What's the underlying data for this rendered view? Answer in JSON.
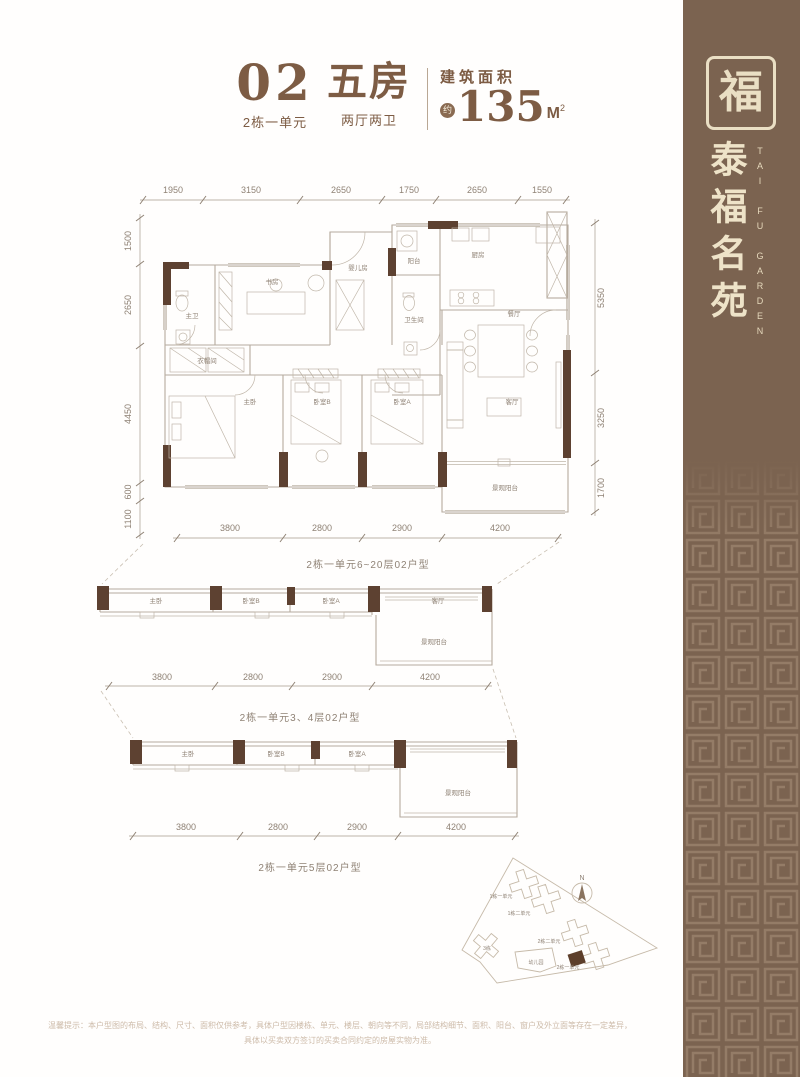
{
  "header": {
    "unit_no": "02",
    "unit_sub": "2栋一单元",
    "type_big": "五房",
    "type_sub": "两厅两卫",
    "area_label": "建筑面积",
    "approx": "约",
    "area_value": "135",
    "area_unit": "M",
    "area_exp": "2"
  },
  "sidebar": {
    "logo_char": "福",
    "brand_cn": "泰福名苑",
    "brand_en": "TAI FU GARDEN"
  },
  "main_plan": {
    "caption": "2栋一单元6~20层02户型",
    "dims_top": [
      "1950",
      "3150",
      "2650",
      "1750",
      "2650",
      "1550"
    ],
    "dims_left": [
      "1500",
      "2650",
      "4450",
      "600",
      "1100"
    ],
    "dims_right": [
      "5350",
      "3250",
      "1700"
    ],
    "dims_bottom": [
      "3800",
      "2800",
      "2900",
      "4200"
    ],
    "rooms": {
      "master_bath": "主卫",
      "study": "书房",
      "baby_room": "婴儿房",
      "balcony": "阳台",
      "kitchen": "厨房",
      "bathroom": "卫生间",
      "dining": "餐厅",
      "cloak": "衣帽间",
      "master_bed": "主卧",
      "bed_b": "卧室B",
      "bed_a": "卧室A",
      "living": "客厅",
      "view_balcony": "景观阳台"
    }
  },
  "mid_plan": {
    "caption": "2栋一单元3、4层02户型",
    "dims": [
      "3800",
      "2800",
      "2900",
      "4200"
    ],
    "rooms": {
      "master_bed": "主卧",
      "bed_b": "卧室B",
      "bed_a": "卧室A",
      "living": "客厅",
      "view_balcony": "景观阳台"
    }
  },
  "low_plan": {
    "caption": "2栋一单元5层02户型",
    "dims": [
      "3800",
      "2800",
      "2900",
      "4200"
    ],
    "rooms": {
      "master_bed": "主卧",
      "bed_b": "卧室B",
      "bed_a": "卧室A",
      "view_balcony": "景观阳台"
    }
  },
  "site_plan": {
    "north": "N",
    "labels": {
      "b1u1": "1栋一单元",
      "b1u2": "1栋二单元",
      "b3": "3栋",
      "kindergarten": "幼儿园",
      "b2u2": "2栋二单元",
      "b2u1": "2栋一单元"
    }
  },
  "disclaimer": {
    "line1": "温馨提示：本户型图的布局、结构、尺寸、面积仅供参考，具体户型因楼栋、单元、楼层、朝向等不同，局部结构细节、面积、阳台、窗户及外立面等存在一定差异，",
    "line2": "具体以买卖双方签订的买卖合同约定的房屋实物为准。"
  },
  "colors": {
    "brand_brown": "#7b6350",
    "accent_text": "#7d5c44",
    "wall_dark": "#5d4131",
    "cream": "#eadfc4"
  }
}
